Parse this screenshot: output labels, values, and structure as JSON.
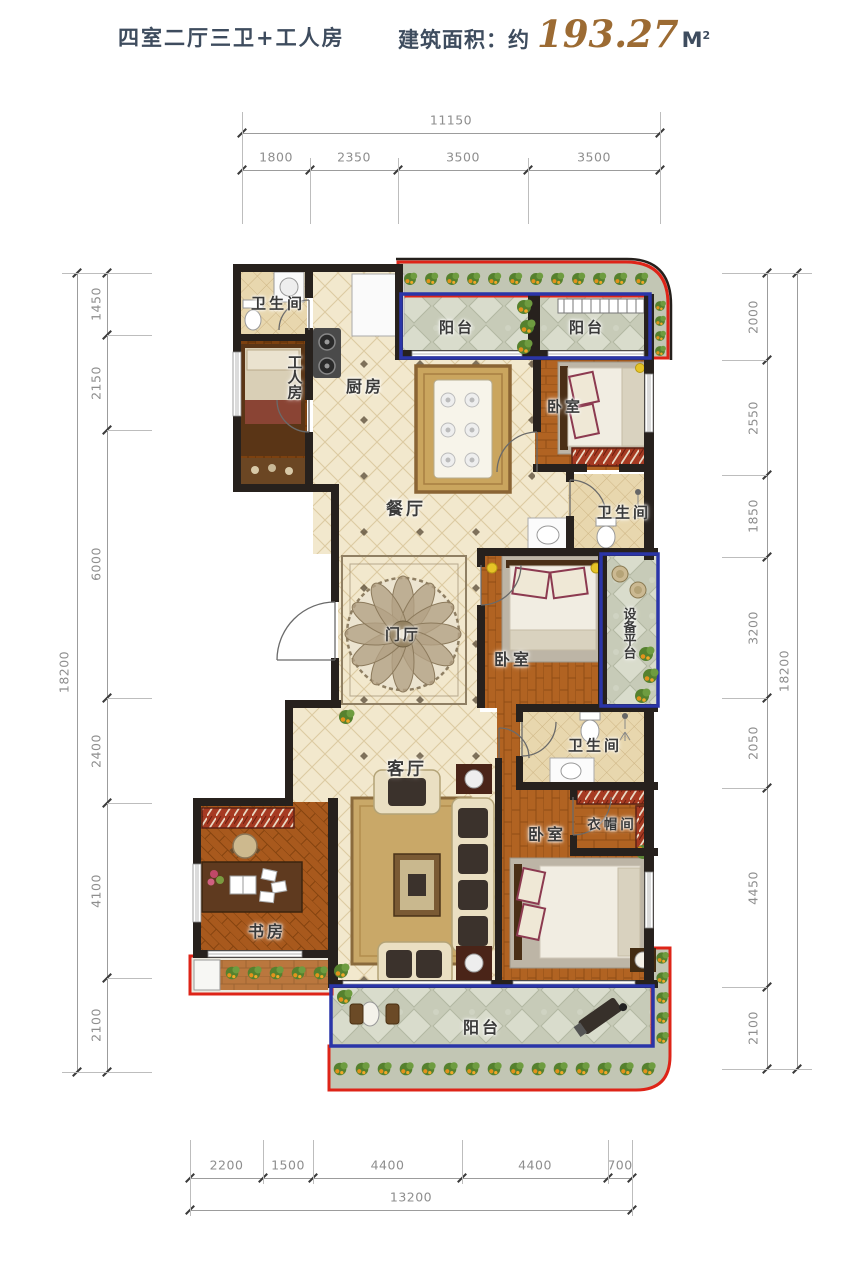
{
  "header": {
    "title": "四室二厅三卫+工人房",
    "area_label": "建筑面积：约",
    "area_value": "193.27",
    "area_unit": "M",
    "area_unit_sup": "2"
  },
  "rooms": [
    {
      "id": "bathroom-top",
      "label": "卫生间"
    },
    {
      "id": "worker-room",
      "label": "工人房"
    },
    {
      "id": "kitchen",
      "label": "厨房"
    },
    {
      "id": "balcony-top-left",
      "label": "阳台"
    },
    {
      "id": "balcony-top-right",
      "label": "阳台"
    },
    {
      "id": "bedroom-top",
      "label": "卧室"
    },
    {
      "id": "dining-room",
      "label": "餐厅"
    },
    {
      "id": "bathroom-mid",
      "label": "卫生间"
    },
    {
      "id": "foyer",
      "label": "门厅"
    },
    {
      "id": "bedroom-mid",
      "label": "卧室"
    },
    {
      "id": "equipment-platform",
      "label": "设备平台"
    },
    {
      "id": "bathroom-bottom",
      "label": "卫生间"
    },
    {
      "id": "cloakroom",
      "label": "衣帽间"
    },
    {
      "id": "bedroom-bottom",
      "label": "卧室"
    },
    {
      "id": "living-room",
      "label": "客厅"
    },
    {
      "id": "study",
      "label": "书房"
    },
    {
      "id": "balcony-bottom",
      "label": "阳台"
    }
  ],
  "dimensions": {
    "top": {
      "total": "11150",
      "segments": [
        "1800",
        "2350",
        "3500",
        "3500"
      ]
    },
    "left": {
      "total": "18200",
      "segments": [
        "1450",
        "2150",
        "6000",
        "2400",
        "4100",
        "2100"
      ]
    },
    "right": {
      "total": "18200",
      "segments": [
        "2000",
        "2550",
        "1850",
        "3200",
        "2050",
        "4450",
        "2100"
      ]
    },
    "bottom": {
      "total": "13200",
      "segments": [
        "2200",
        "1500",
        "4400",
        "4400",
        "700"
      ]
    }
  },
  "colors": {
    "title_color": "#3e4c5e",
    "area_value_color": "#9c6b33",
    "dim_text": "#8e8e8e",
    "wall": "#27211d",
    "accent_red": "#de2418",
    "accent_blue": "#2a35a8",
    "floor_tile_cream": "#f2e8cd",
    "floor_wood": "#b16322",
    "floor_stone": "#c7cbb8"
  }
}
